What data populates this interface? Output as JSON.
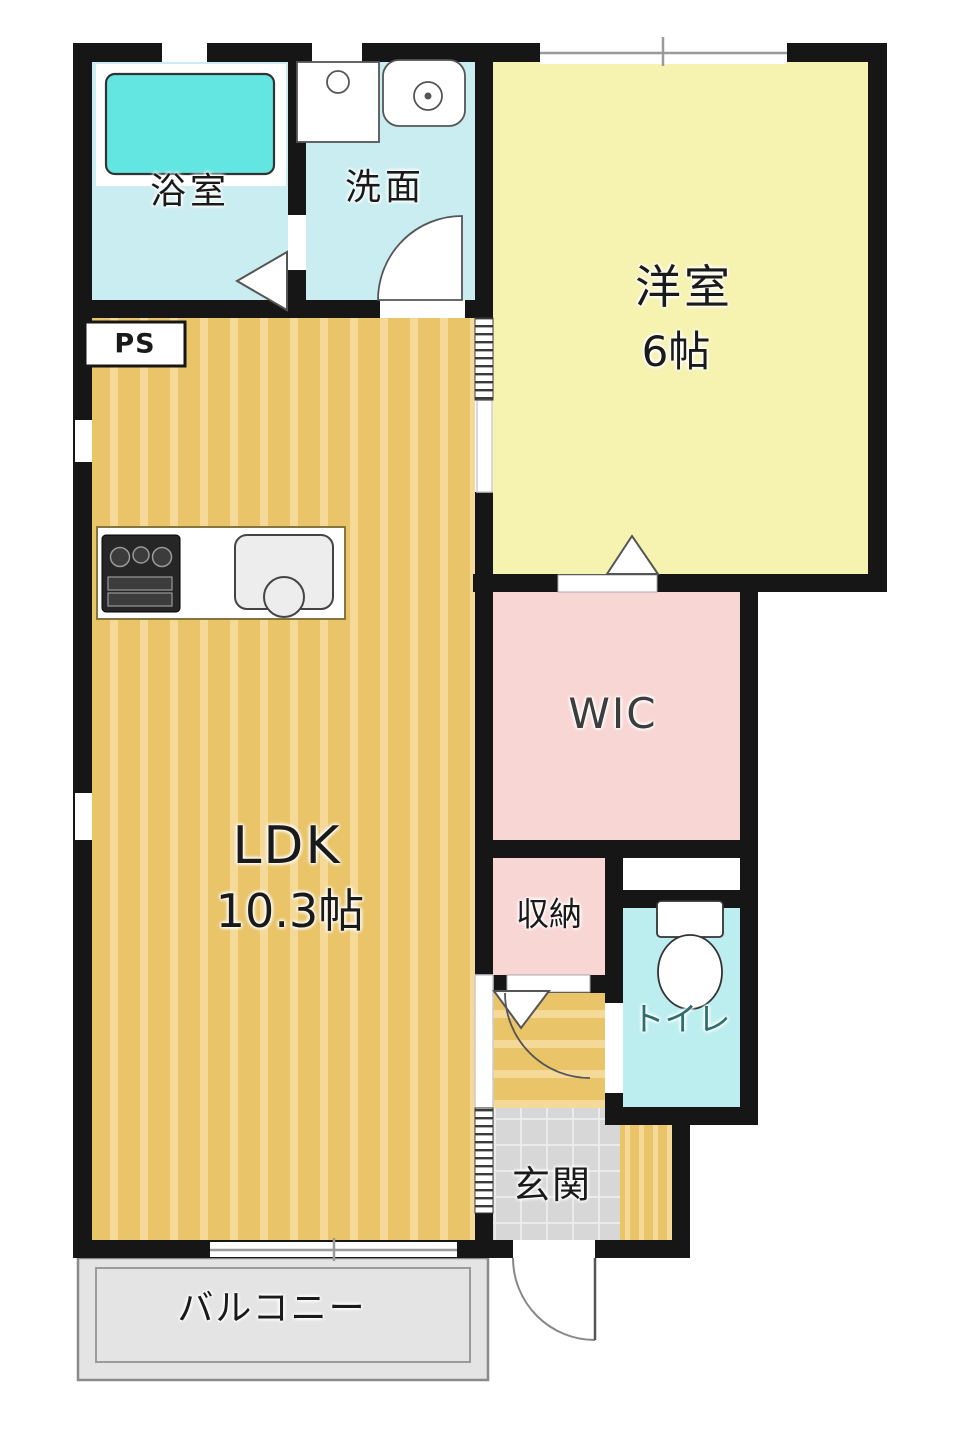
{
  "plan": {
    "type": "apartment-floor-plan",
    "rooms": {
      "bath": {
        "label": "浴室"
      },
      "washroom": {
        "label": "洗面"
      },
      "pipe_space": {
        "label": "PS"
      },
      "western_room": {
        "label": "洋室",
        "size": "6帖"
      },
      "ldk": {
        "label": "LDK",
        "size": "10.3帖"
      },
      "wic": {
        "label": "WIC"
      },
      "storage": {
        "label": "収納"
      },
      "toilet": {
        "label": "トイレ"
      },
      "entrance": {
        "label": "玄関"
      },
      "balcony": {
        "label": "バルコニー"
      }
    },
    "fixtures": [
      "bathtub",
      "washing-machine-pan",
      "vanity-sink",
      "gas-stove",
      "kitchen-sink",
      "toilet-bowl"
    ]
  },
  "colors": {
    "wall": "#161616",
    "wet_room": "#c9edf0",
    "toilet_room": "#bceef0",
    "bathtub": "#63e6e2",
    "western_room": "#f6f2af",
    "closet_pink": "#f8d6d4",
    "wood_base": "#e9c468",
    "wood_stripe": "#f5d999",
    "entrance_tile": "#d7d7d7",
    "tile_line": "#ebebeb",
    "balcony": "#e4e4e4",
    "toilet_text": "#2e6e6e"
  }
}
